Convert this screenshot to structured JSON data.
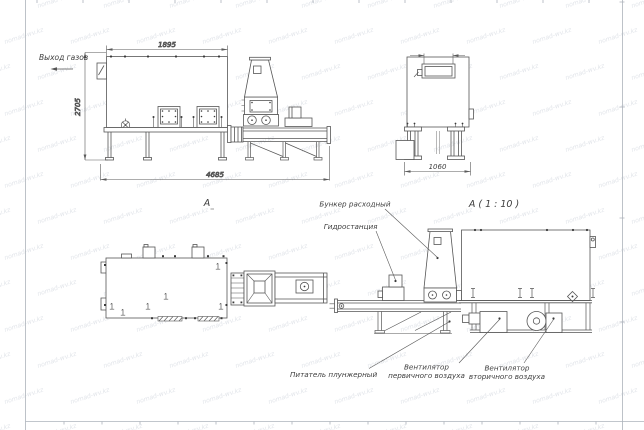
{
  "labels": {
    "gas_outlet": "Выход газов",
    "view_a": "А",
    "view_a_scale": "А ( 1 : 10 )",
    "hopper": "Бункер расходный",
    "hydro_station": "Гидростанция",
    "plunger_feeder": "Питатель плунжерный",
    "primary_fan_line1": "Вентилятор",
    "primary_fan_line2": "первичного воздуха",
    "secondary_fan_line1": "Вентилятор",
    "secondary_fan_line2": "вторичного воздуха"
  },
  "dimensions": {
    "body_width": "1895",
    "body_height": "2705",
    "total_length": "4685",
    "end_view_width": "1060"
  },
  "watermark": {
    "text": "nomad-wv.kz"
  },
  "colors": {
    "line": "#565656",
    "thin_line": "#5a5a5a",
    "frame": "#adb3bb",
    "text": "#3d3d3d",
    "watermark": "#e2e5ea",
    "background": "#ffffff"
  }
}
